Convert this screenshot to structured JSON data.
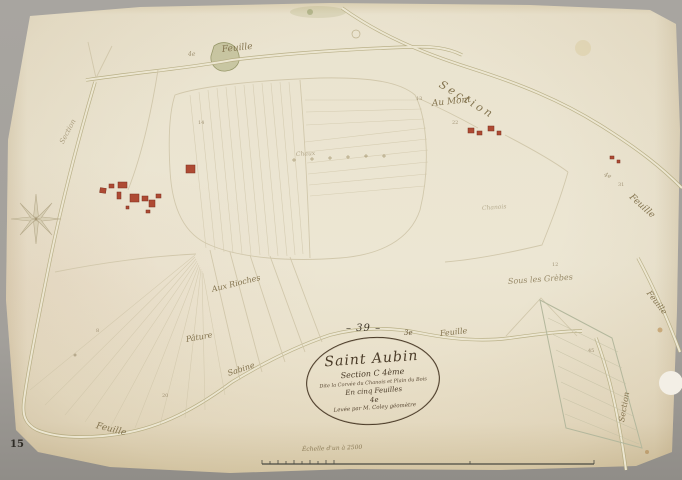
{
  "colors": {
    "paper": "#eae3cf",
    "ink": "#4a3b28",
    "faded_ink": "#84744f",
    "building_red": "#ae4a33",
    "road": "#b9b184",
    "background": "#a3a09b"
  },
  "scan": {
    "page_number": "15"
  },
  "map": {
    "sheet_mark": "– 39 –",
    "adjacent_mark": "3e",
    "cartouche": {
      "title": "Saint Aubin",
      "line2": "Section C 4ème",
      "line3": "Dite la Corvée du Chanois et Plain du Bois",
      "line4": "En cinq Feuilles",
      "line5": "4e",
      "line6": "Levée par M. Coley géomètre"
    },
    "scale": {
      "caption": "Échelle d'un à 2500"
    },
    "labels": {
      "feuille_top": "Feuille",
      "section_topright": "Section",
      "au_mont": "Au Mont",
      "chaux": "Chaux",
      "chanois": "Chanois",
      "sous_les_grebes": "Sous les Grèbes",
      "aux_rioches": "Aux Rioches",
      "pature": "Pâture",
      "sabine_road": "Sabine",
      "feuille_center": "Feuille",
      "feuille_right_upper": "Feuille",
      "feuille_right_lower": "Feuille",
      "feuille_bottom_left": "Feuille",
      "section_bottomright": "Section",
      "section_left": "Section",
      "fe_top": "4e",
      "fe_mid": "4e"
    },
    "parcel_numbers": [
      "14",
      "13",
      "22",
      "12",
      "8",
      "20",
      "45",
      "31"
    ]
  }
}
